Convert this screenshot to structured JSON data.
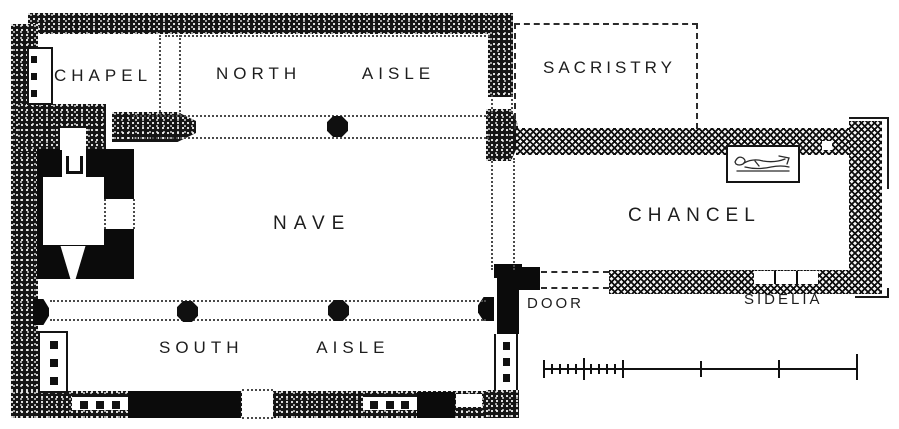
{
  "figure": {
    "kind": "church ground plan (engraved survey drawing)",
    "canvas": {
      "width": 899,
      "height": 429
    }
  },
  "colors": {
    "paper": "#ffffff",
    "ink": "#141414"
  },
  "rooms": {
    "chapel": {
      "label": "CHAPEL"
    },
    "north_aisle": {
      "label": "NORTH AISLE"
    },
    "sacristy": {
      "label": "SACRISTRY"
    },
    "nave": {
      "label": "NAVE"
    },
    "chancel": {
      "label": "CHANCEL"
    },
    "south_aisle": {
      "label": "SOUTH AISLE"
    }
  },
  "annotations": {
    "door": {
      "label": "DOOR"
    },
    "sedilia": {
      "label": "SIDELIA"
    }
  },
  "features": {
    "tower": "west-tower-solid-walls",
    "pillars": "octagonal-arcade-piers",
    "tomb": "recumbent-effigy-recess",
    "scale_bar": "graphic-scale-bar",
    "sacristy_outline": "dashed-demolished-outline"
  }
}
